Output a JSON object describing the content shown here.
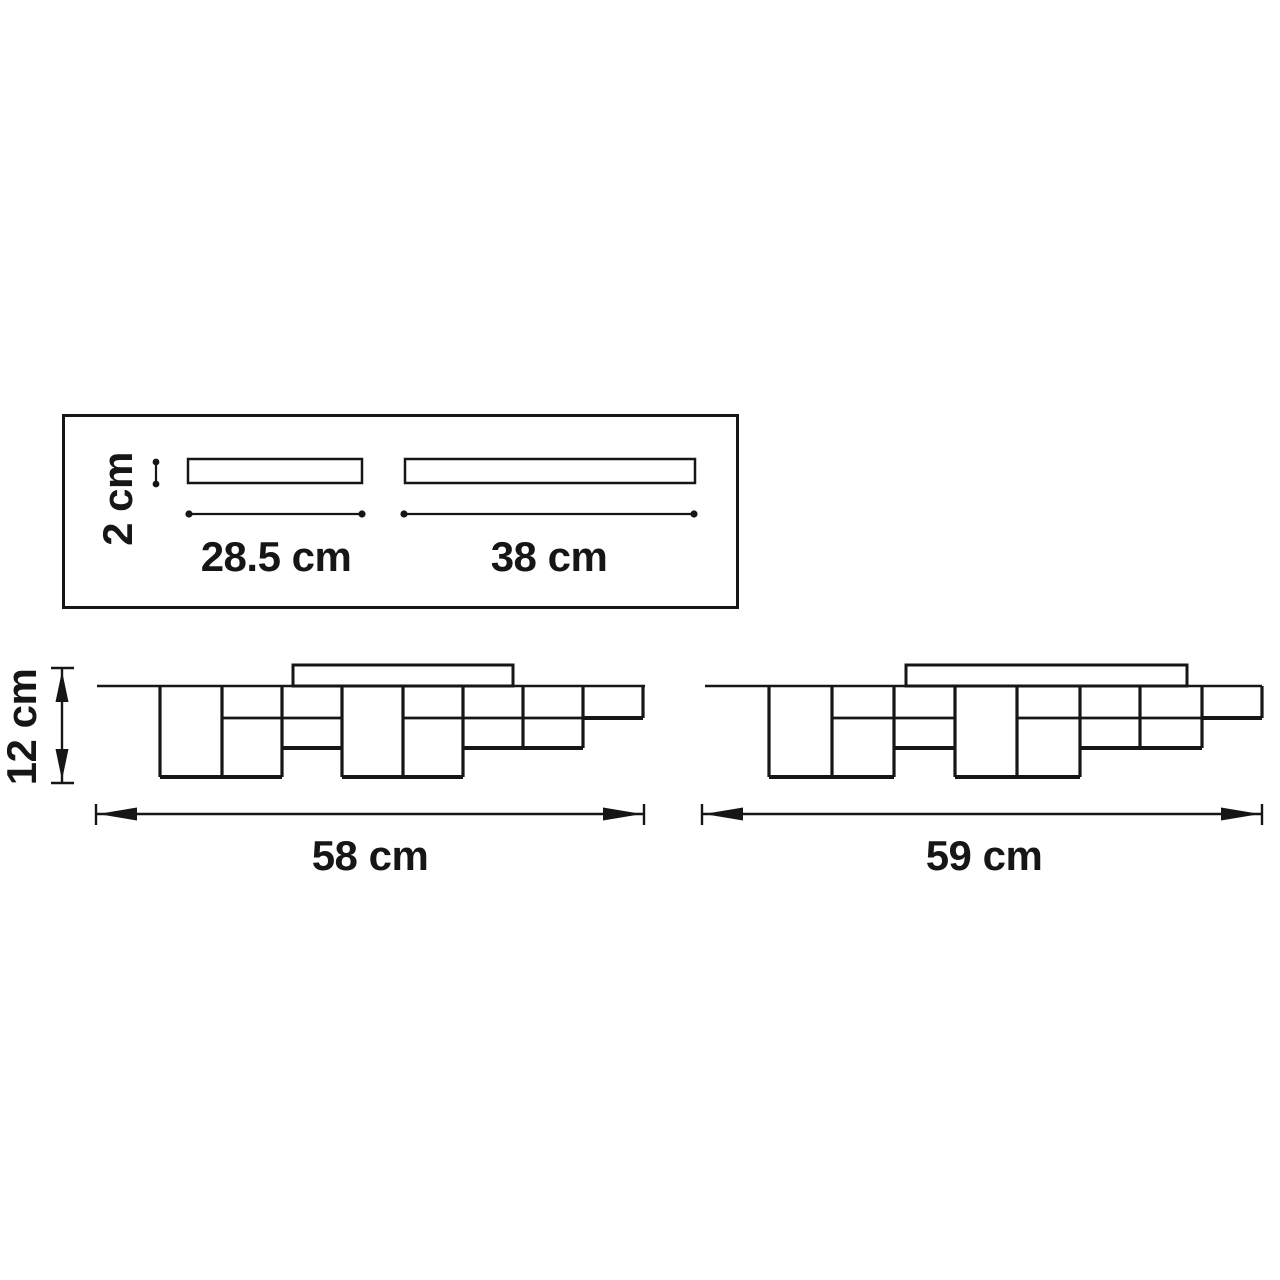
{
  "diagram": {
    "kind": "technical dimension drawing",
    "subject": "ceiling light fixture — top view of mounting bars and two side elevations",
    "colors": {
      "line": "#161616",
      "background": "#ffffff"
    },
    "top_view": {
      "bar_thickness_label": "2 cm",
      "bar1_length_label": "28.5 cm",
      "bar2_length_label": "38 cm"
    },
    "side_view_left": {
      "height_label": "12 cm",
      "width_label": "58 cm"
    },
    "side_view_right": {
      "width_label": "59 cm"
    }
  }
}
